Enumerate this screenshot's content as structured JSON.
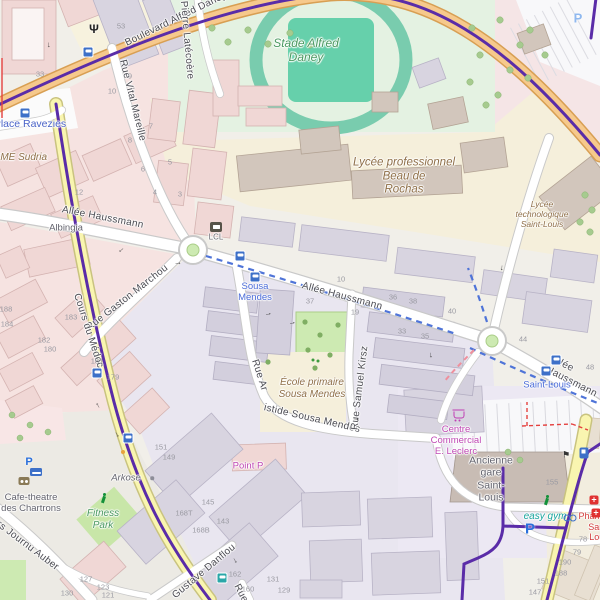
{
  "map_title": "Bordeaux Saint-Louis / Chartrons district map",
  "colors": {
    "tram_line": "#5a2ca8",
    "tram_construction_dash": "#4f74d8",
    "branch_dash": "#ef8f9c",
    "boulevard_fill": "#f6c98c",
    "secondary_fill": "#f9f5b0",
    "road_fill": "#ffffff",
    "transit_blue": "#3d70c8",
    "poi_brown": "#8f6f48",
    "leisure_green": "#4c9a62",
    "shop_magenta": "#bf48b4",
    "health_red": "#d23b3b",
    "label_blue": "#4a63c8",
    "park_green": "#cdeab2",
    "stadium_track": "#79ccae"
  },
  "street_labels": [
    {
      "t": "Boulevard Alfred Daney",
      "x": 126,
      "y": 44,
      "r": -26,
      "c": "st"
    },
    {
      "t": "Pierre Latécoère",
      "x": 183,
      "y": 1,
      "r": 85,
      "c": "st"
    },
    {
      "t": "Rue Vital Mareille",
      "x": 122,
      "y": 60,
      "r": 76,
      "c": "st"
    },
    {
      "t": "Allée Haussmann",
      "x": 62,
      "y": 210,
      "r": 11,
      "c": "st"
    },
    {
      "t": "Allée Haussmann",
      "x": 302,
      "y": 286,
      "r": 15,
      "c": "st"
    },
    {
      "t": "Allée Haussmann",
      "x": 549,
      "y": 364,
      "r": 27,
      "c": "st"
    },
    {
      "t": "Rue Gaston Marchou",
      "x": 88,
      "y": 329,
      "r": -38,
      "c": "st"
    },
    {
      "t": "Cours du Médoc",
      "x": 76,
      "y": 294,
      "r": 72,
      "c": "st"
    },
    {
      "t": "Rue Ar",
      "x": 254,
      "y": 360,
      "r": 72,
      "c": "st"
    },
    {
      "t": "istide Sousa Mendes",
      "x": 264,
      "y": 408,
      "r": 13,
      "c": "st"
    },
    {
      "t": "Rue Samuel Kirsz",
      "x": 355,
      "y": 430,
      "r": -83,
      "c": "st"
    },
    {
      "t": "Gustave Danflou",
      "x": 174,
      "y": 597,
      "r": -40,
      "c": "st"
    },
    {
      "t": "Cours Journu Auber",
      "x": -18,
      "y": 512,
      "r": 37,
      "c": "st"
    },
    {
      "t": "Rue",
      "x": 236,
      "y": 585,
      "r": 62,
      "c": "st"
    }
  ],
  "poi_labels": [
    {
      "t": "Stade Alfred\nDaney",
      "x": 306,
      "y": 50,
      "c": "poi-green big"
    },
    {
      "t": "Lycée professionnel\nBeau de\nRochas",
      "x": 404,
      "y": 177,
      "c": "poi-brown big"
    },
    {
      "t": "Lycée technologique\nSaint-Louis",
      "x": 542,
      "y": 214,
      "c": "poi-brown sm"
    },
    {
      "t": "École primaire\nSousa Mendes",
      "x": 312,
      "y": 389,
      "c": "poi-brown"
    },
    {
      "t": "Place Ravezies",
      "x": 30,
      "y": 124,
      "c": "place"
    },
    {
      "t": "ESME Sudria",
      "x": 17,
      "y": 158,
      "c": "poi-brown"
    },
    {
      "t": "Albingia",
      "x": 66,
      "y": 228,
      "c": "poi-gray"
    },
    {
      "t": "Sousa\nMendes",
      "x": 255,
      "y": 292,
      "c": "transit"
    },
    {
      "t": "Saint-Louis",
      "x": 547,
      "y": 385,
      "c": "transit"
    },
    {
      "t": "LCL",
      "x": 216,
      "y": 237,
      "c": "poi-gray xs"
    },
    {
      "t": "Centre\nCommercial\nE. Leclerc",
      "x": 456,
      "y": 441,
      "c": "magenta"
    },
    {
      "t": "Ancienne\ngare\nSaint-\nLouis",
      "x": 491,
      "y": 479,
      "c": "poi-gray md"
    },
    {
      "t": "Point P",
      "x": 248,
      "y": 466,
      "c": "magenta"
    },
    {
      "t": "Arkose",
      "x": 126,
      "y": 478,
      "c": "poi-gray i"
    },
    {
      "t": "Fitness\nPark",
      "x": 103,
      "y": 520,
      "c": "poi-green"
    },
    {
      "t": "Cafe-theatre\ndes Chartrons",
      "x": 31,
      "y": 503,
      "c": "poi-gray"
    },
    {
      "t": "easy gym",
      "x": 545,
      "y": 517,
      "c": "teal"
    },
    {
      "t": "Pharmacie\nSaint-Louis",
      "x": 600,
      "y": 527,
      "c": "red"
    }
  ],
  "house_numbers": [
    {
      "t": "53",
      "x": 121,
      "y": 27
    },
    {
      "t": "33",
      "x": 40,
      "y": 75
    },
    {
      "t": "9",
      "x": 130,
      "y": 77
    },
    {
      "t": "10",
      "x": 112,
      "y": 92
    },
    {
      "t": "7",
      "x": 151,
      "y": 127
    },
    {
      "t": "8",
      "x": 130,
      "y": 141
    },
    {
      "t": "5",
      "x": 170,
      "y": 163
    },
    {
      "t": "6",
      "x": 143,
      "y": 170
    },
    {
      "t": "4",
      "x": 155,
      "y": 193
    },
    {
      "t": "3",
      "x": 180,
      "y": 195
    },
    {
      "t": "12",
      "x": 79,
      "y": 193
    },
    {
      "t": "10",
      "x": 341,
      "y": 280
    },
    {
      "t": "37",
      "x": 310,
      "y": 302
    },
    {
      "t": "19",
      "x": 355,
      "y": 313
    },
    {
      "t": "36",
      "x": 393,
      "y": 298
    },
    {
      "t": "38",
      "x": 413,
      "y": 302
    },
    {
      "t": "40",
      "x": 452,
      "y": 312
    },
    {
      "t": "33",
      "x": 402,
      "y": 332
    },
    {
      "t": "35",
      "x": 425,
      "y": 337
    },
    {
      "t": "44",
      "x": 523,
      "y": 340
    },
    {
      "t": "48",
      "x": 590,
      "y": 368
    },
    {
      "t": "188",
      "x": 6,
      "y": 310
    },
    {
      "t": "184",
      "x": 7,
      "y": 325
    },
    {
      "t": "183",
      "x": 71,
      "y": 318
    },
    {
      "t": "182",
      "x": 44,
      "y": 341
    },
    {
      "t": "180",
      "x": 50,
      "y": 350
    },
    {
      "t": "181",
      "x": 97,
      "y": 362
    },
    {
      "t": "179",
      "x": 113,
      "y": 378
    },
    {
      "t": "151",
      "x": 161,
      "y": 448
    },
    {
      "t": "149",
      "x": 169,
      "y": 458
    },
    {
      "t": "145",
      "x": 208,
      "y": 503
    },
    {
      "t": "143",
      "x": 223,
      "y": 522
    },
    {
      "t": "168T",
      "x": 184,
      "y": 514
    },
    {
      "t": "168B",
      "x": 201,
      "y": 531
    },
    {
      "t": "162",
      "x": 235,
      "y": 575
    },
    {
      "t": "160",
      "x": 248,
      "y": 590
    },
    {
      "t": "131",
      "x": 273,
      "y": 580
    },
    {
      "t": "129",
      "x": 284,
      "y": 591
    },
    {
      "t": "127",
      "x": 86,
      "y": 580
    },
    {
      "t": "123",
      "x": 103,
      "y": 588
    },
    {
      "t": "121",
      "x": 108,
      "y": 596
    },
    {
      "t": "130",
      "x": 67,
      "y": 594
    },
    {
      "t": "155",
      "x": 552,
      "y": 483
    },
    {
      "t": "78",
      "x": 583,
      "y": 540
    },
    {
      "t": "79",
      "x": 577,
      "y": 553
    },
    {
      "t": "190",
      "x": 565,
      "y": 563
    },
    {
      "t": "188",
      "x": 561,
      "y": 574
    },
    {
      "t": "151",
      "x": 543,
      "y": 582
    },
    {
      "t": "147",
      "x": 535,
      "y": 593
    }
  ],
  "icons": [
    {
      "k": "bus",
      "x": 88,
      "y": 52
    },
    {
      "k": "bus",
      "x": 25,
      "y": 113
    },
    {
      "k": "tram",
      "x": 240,
      "y": 256
    },
    {
      "k": "tram",
      "x": 255,
      "y": 277
    },
    {
      "k": "tram",
      "x": 556,
      "y": 360
    },
    {
      "k": "tram",
      "x": 546,
      "y": 371
    },
    {
      "k": "bus",
      "x": 97,
      "y": 373
    },
    {
      "k": "bus",
      "x": 128,
      "y": 438
    },
    {
      "k": "bus-teal",
      "x": 222,
      "y": 578
    },
    {
      "k": "parking",
      "x": 530,
      "y": 529
    },
    {
      "k": "parking-top",
      "x": 578,
      "y": 18
    },
    {
      "k": "parking-sm",
      "x": 29,
      "y": 462
    },
    {
      "k": "fuel",
      "x": 584,
      "y": 453
    },
    {
      "k": "bed",
      "x": 36,
      "y": 472
    },
    {
      "k": "theater",
      "x": 24,
      "y": 481
    },
    {
      "k": "cart",
      "x": 459,
      "y": 415
    },
    {
      "k": "runner",
      "x": 547,
      "y": 500
    },
    {
      "k": "runner",
      "x": 104,
      "y": 498
    },
    {
      "k": "bicycle",
      "x": 570,
      "y": 517
    },
    {
      "k": "pharmacy",
      "x": 594,
      "y": 500
    },
    {
      "k": "pharmacy",
      "x": 596,
      "y": 513
    },
    {
      "k": "lcl",
      "x": 216,
      "y": 227
    },
    {
      "k": "w",
      "x": 94,
      "y": 29
    },
    {
      "k": "dot-orange",
      "x": 123,
      "y": 452
    },
    {
      "k": "dot-gray",
      "x": 152,
      "y": 478
    },
    {
      "k": "playground",
      "x": 316,
      "y": 361
    },
    {
      "k": "flag",
      "x": 566,
      "y": 455
    }
  ],
  "icon_glyphs": {
    "parking": "P",
    "parking-top": "P",
    "parking-sm": "P",
    "pharmacy": "+",
    "w": "Ψ",
    "flag": "⚑",
    "arrow": "→"
  },
  "arrows": [
    {
      "x": 122,
      "y": 251,
      "r": 140
    },
    {
      "x": 268,
      "y": 313,
      "r": -15
    },
    {
      "x": 292,
      "y": 322,
      "r": -15
    },
    {
      "x": 432,
      "y": 355,
      "r": 85
    },
    {
      "x": 118,
      "y": 434,
      "r": 60
    },
    {
      "x": 97,
      "y": 406,
      "r": -120
    },
    {
      "x": 356,
      "y": 418,
      "r": 5
    },
    {
      "x": 503,
      "y": 268,
      "r": 95
    },
    {
      "x": 178,
      "y": 262,
      "r": 0
    },
    {
      "x": 50,
      "y": 45,
      "r": 90
    },
    {
      "x": 236,
      "y": 560,
      "r": 60
    }
  ]
}
